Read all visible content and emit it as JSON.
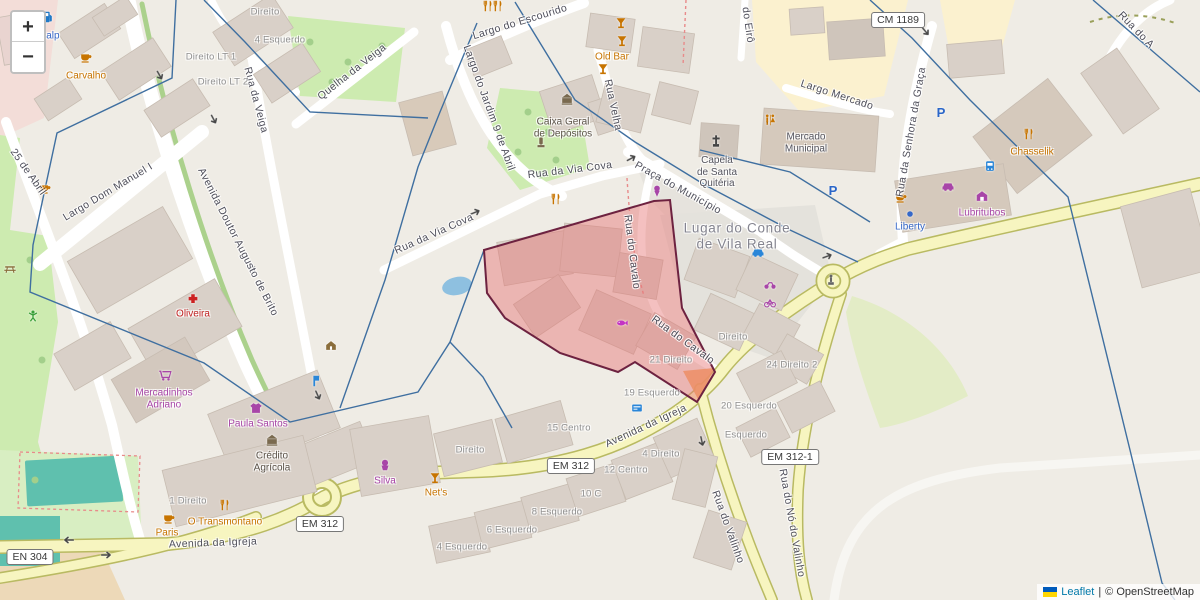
{
  "zoom_control": {
    "zoom_in": "+",
    "zoom_out": "−"
  },
  "attribution": {
    "leaflet": "Leaflet",
    "separator": "|",
    "osm_credit": "© OpenStreetMap"
  },
  "shields": [
    {
      "t": "CM 1189",
      "x": 898,
      "y": 20
    },
    {
      "t": "EM 312",
      "x": 571,
      "y": 466
    },
    {
      "t": "EM 312",
      "x": 320,
      "y": 524
    },
    {
      "t": "EM 312-1",
      "x": 790,
      "y": 457
    },
    {
      "t": "EN 304",
      "x": 30,
      "y": 557
    }
  ],
  "street_labels": [
    {
      "t": "Largo do Escourido",
      "x": 520,
      "y": 22,
      "r": -17
    },
    {
      "t": "Largo do Jardim 9 de Abril",
      "x": 489,
      "y": 108,
      "r": 70
    },
    {
      "t": "Quelha da Veiga",
      "x": 352,
      "y": 72,
      "r": -38
    },
    {
      "t": "Rua da Veiga",
      "x": 256,
      "y": 100,
      "r": 75
    },
    {
      "t": "Largo Dom Manuel I",
      "x": 108,
      "y": 192,
      "r": -31
    },
    {
      "t": "Avenida Doutor Augusto de Brito",
      "x": 238,
      "y": 242,
      "r": 63
    },
    {
      "t": "Rua da Via Cova",
      "x": 570,
      "y": 170,
      "r": -7
    },
    {
      "t": "Rua da Via Cova",
      "x": 434,
      "y": 234,
      "r": -24
    },
    {
      "t": "Rua Velha",
      "x": 613,
      "y": 105,
      "r": 78
    },
    {
      "t": "Praça do Município",
      "x": 678,
      "y": 188,
      "r": 29
    },
    {
      "t": "Largo Mercado",
      "x": 837,
      "y": 95,
      "r": 18
    },
    {
      "t": "Rua da Senhora da Graça",
      "x": 911,
      "y": 132,
      "r": -80
    },
    {
      "t": "do Eirô",
      "x": 748,
      "y": 25,
      "r": 82
    },
    {
      "t": "Rua do A",
      "x": 1136,
      "y": 30,
      "r": 46
    },
    {
      "t": "25 de Abril",
      "x": 28,
      "y": 172,
      "r": 55
    },
    {
      "t": "Rua do Cavalo",
      "x": 632,
      "y": 252,
      "r": 83
    },
    {
      "t": "Rua do Cavalo",
      "x": 683,
      "y": 340,
      "r": 36
    },
    {
      "t": "Avenida da Igreja",
      "x": 646,
      "y": 426,
      "r": -25
    },
    {
      "t": "Avenida da Igreja",
      "x": 213,
      "y": 543,
      "r": -2
    },
    {
      "t": "Rua do Valinho",
      "x": 728,
      "y": 527,
      "r": 70
    },
    {
      "t": "Rua do Nó do Valinho",
      "x": 792,
      "y": 523,
      "r": 80
    }
  ],
  "poi_labels": [
    {
      "t": "Galp",
      "x": 49,
      "y": 36,
      "c": "blue"
    },
    {
      "t": "Carvalho",
      "x": 86,
      "y": 76,
      "c": "orange"
    },
    {
      "t": "Old Bar",
      "x": 612,
      "y": 57,
      "c": "orange"
    },
    {
      "t": "Oliveira",
      "x": 193,
      "y": 314,
      "c": "red"
    },
    {
      "t": "Mercadinhos\nAdriano",
      "x": 164,
      "y": 399,
      "c": "purple"
    },
    {
      "t": "Paula Santos",
      "x": 258,
      "y": 424,
      "c": "purple"
    },
    {
      "t": "Crédito\nAgrícola",
      "x": 272,
      "y": 462,
      "c": "dark"
    },
    {
      "t": "O Transmontano",
      "x": 225,
      "y": 522,
      "c": "orange"
    },
    {
      "t": "Paris",
      "x": 167,
      "y": 533,
      "c": "orange"
    },
    {
      "t": "Silva",
      "x": 385,
      "y": 481,
      "c": "purple"
    },
    {
      "t": "Net's",
      "x": 436,
      "y": 493,
      "c": "orange"
    },
    {
      "t": "Chasselik",
      "x": 1032,
      "y": 152,
      "c": "orange"
    },
    {
      "t": "Lubritubos",
      "x": 982,
      "y": 213,
      "c": "purple"
    },
    {
      "t": "Liberty",
      "x": 910,
      "y": 227,
      "c": "blue"
    },
    {
      "t": "Caixa Geral\nde Depósitos",
      "x": 563,
      "y": 128,
      "c": "dark"
    },
    {
      "t": "Mercado\nMunicipal",
      "x": 806,
      "y": 143,
      "c": "gray"
    },
    {
      "t": "Capela\nde Santa\nQuitéria",
      "x": 717,
      "y": 172,
      "c": "gray"
    },
    {
      "t": "Lugar do Conde\nde Vila Real",
      "x": 737,
      "y": 236,
      "c": "place"
    }
  ],
  "addr_labels": [
    {
      "t": "Direito",
      "x": 265,
      "y": 13
    },
    {
      "t": "4 Esquerdo",
      "x": 280,
      "y": 41
    },
    {
      "t": "Direito\nLT 1",
      "x": 211,
      "y": 58
    },
    {
      "t": "Direito\nLT 2",
      "x": 223,
      "y": 83
    },
    {
      "t": "Direito",
      "x": 470,
      "y": 451
    },
    {
      "t": "15 Centro",
      "x": 569,
      "y": 429
    },
    {
      "t": "21 Direito",
      "x": 671,
      "y": 361
    },
    {
      "t": "19 Esquerdo",
      "x": 652,
      "y": 394
    },
    {
      "t": "20 Esquerdo",
      "x": 749,
      "y": 407
    },
    {
      "t": "24 Direito\n2",
      "x": 792,
      "y": 366
    },
    {
      "t": "Esquerdo",
      "x": 746,
      "y": 436
    },
    {
      "t": "4 Direito",
      "x": 661,
      "y": 455
    },
    {
      "t": "12 Centro",
      "x": 626,
      "y": 471
    },
    {
      "t": "10 C",
      "x": 591,
      "y": 495
    },
    {
      "t": "8 Esquerdo",
      "x": 557,
      "y": 513
    },
    {
      "t": "6 Esquerdo",
      "x": 512,
      "y": 531
    },
    {
      "t": "4 Esquerdo",
      "x": 462,
      "y": 548
    },
    {
      "t": "1 Direito",
      "x": 188,
      "y": 502
    },
    {
      "t": "Direito",
      "x": 733,
      "y": 338
    }
  ],
  "icons": [
    {
      "n": "fuel-station",
      "s": "fuel",
      "x": 47,
      "y": 17,
      "color": "#2079c7"
    },
    {
      "n": "cafe-cup",
      "s": "cup",
      "x": 86,
      "y": 57,
      "color": "#c77400"
    },
    {
      "n": "cafe-cup",
      "s": "cup",
      "x": 169,
      "y": 518,
      "color": "#c77400"
    },
    {
      "n": "cafe-cup",
      "s": "cup",
      "x": 45,
      "y": 188,
      "color": "#c77400"
    },
    {
      "n": "cafe-cup",
      "s": "cup",
      "x": 901,
      "y": 197,
      "color": "#c77400"
    },
    {
      "n": "bar-cocktail",
      "s": "cocktail",
      "x": 621,
      "y": 23,
      "color": "#c77400"
    },
    {
      "n": "bar-cocktail",
      "s": "cocktail",
      "x": 622,
      "y": 41,
      "color": "#c77400"
    },
    {
      "n": "bar-cocktail",
      "s": "cocktail",
      "x": 603,
      "y": 69,
      "color": "#c77400"
    },
    {
      "n": "bar-cocktail",
      "s": "cocktail",
      "x": 435,
      "y": 478,
      "color": "#c77400"
    },
    {
      "n": "restaurant",
      "s": "forkknife",
      "x": 488,
      "y": 6,
      "color": "#c77400"
    },
    {
      "n": "restaurant",
      "s": "forkknife",
      "x": 498,
      "y": 6,
      "color": "#c77400"
    },
    {
      "n": "restaurant",
      "s": "forkknife",
      "x": 556,
      "y": 199,
      "color": "#c77400"
    },
    {
      "n": "restaurant",
      "s": "forkknife",
      "x": 225,
      "y": 505,
      "color": "#c77400"
    },
    {
      "n": "restaurant",
      "s": "forkknife",
      "x": 1029,
      "y": 134,
      "color": "#c77400"
    },
    {
      "n": "toilets",
      "s": "toilets",
      "x": 770,
      "y": 120,
      "color": "#c77400"
    },
    {
      "n": "pharmacy",
      "s": "pharmacy",
      "x": 193,
      "y": 299,
      "color": "#cc2222"
    },
    {
      "n": "supermarket-cart",
      "s": "cart",
      "x": 165,
      "y": 375,
      "color": "#a845a8"
    },
    {
      "n": "clothes-shop",
      "s": "shirt",
      "x": 256,
      "y": 408,
      "color": "#a845a8"
    },
    {
      "n": "confectionery",
      "s": "cake",
      "x": 385,
      "y": 465,
      "color": "#a845a8"
    },
    {
      "n": "car-repair",
      "s": "car",
      "x": 948,
      "y": 186,
      "color": "#a845a8"
    },
    {
      "n": "garage",
      "s": "garage",
      "x": 982,
      "y": 196,
      "color": "#a845a8"
    },
    {
      "n": "ice-cream",
      "s": "icecream",
      "x": 657,
      "y": 191,
      "color": "#a845a8"
    },
    {
      "n": "motorcycle-parking",
      "s": "motorcycle",
      "x": 770,
      "y": 284,
      "color": "#a845a8"
    },
    {
      "n": "bicycle-parking",
      "s": "bicycle",
      "x": 770,
      "y": 302,
      "color": "#a845a8"
    },
    {
      "n": "fishmonger",
      "s": "fish",
      "x": 622,
      "y": 323,
      "color": "#c433c4"
    },
    {
      "n": "bank",
      "s": "bank",
      "x": 272,
      "y": 440,
      "color": "#7a6a4f"
    },
    {
      "n": "bank",
      "s": "bank",
      "x": 567,
      "y": 99,
      "color": "#7a6a4f"
    },
    {
      "n": "memorial",
      "s": "memorial",
      "x": 541,
      "y": 142,
      "color": "#7a6a4f"
    },
    {
      "n": "kiosk-hut",
      "s": "hut",
      "x": 331,
      "y": 345,
      "color": "#8a6d3b"
    },
    {
      "n": "picnic-table",
      "s": "picnic",
      "x": 10,
      "y": 268,
      "color": "#8a6d3b"
    },
    {
      "n": "playground",
      "s": "playground",
      "x": 33,
      "y": 316,
      "color": "#3aa03a"
    },
    {
      "n": "church-cross",
      "s": "cross",
      "x": 716,
      "y": 141,
      "color": "#444444"
    },
    {
      "n": "statue",
      "s": "statue",
      "x": 831,
      "y": 280,
      "color": "#666666"
    },
    {
      "n": "parking",
      "s": "parking",
      "x": 941,
      "y": 112,
      "color": "#2a66c8"
    },
    {
      "n": "parking",
      "s": "parking",
      "x": 833,
      "y": 190,
      "color": "#2a66c8"
    },
    {
      "n": "taxi",
      "s": "car",
      "x": 758,
      "y": 252,
      "color": "#2a86d8"
    },
    {
      "n": "office-dot",
      "s": "dot",
      "x": 910,
      "y": 214,
      "color": "#3568c9"
    },
    {
      "n": "bus-station",
      "s": "bus",
      "x": 990,
      "y": 166,
      "color": "#2a86d8"
    },
    {
      "n": "bus-stop",
      "s": "busstop",
      "x": 316,
      "y": 381,
      "color": "#2a86d8"
    },
    {
      "n": "atm",
      "s": "atm",
      "x": 637,
      "y": 408,
      "color": "#2a86d8"
    },
    {
      "n": "oneway-arrow",
      "s": "arrow",
      "x": 160,
      "y": 76,
      "color": "#484848",
      "r": 60
    },
    {
      "n": "oneway-arrow",
      "s": "arrow",
      "x": 214,
      "y": 120,
      "color": "#484848",
      "r": 62
    },
    {
      "n": "oneway-arrow",
      "s": "arrow",
      "x": 252,
      "y": 268,
      "color": "#484848",
      "r": 64
    },
    {
      "n": "oneway-arrow",
      "s": "arrow",
      "x": 318,
      "y": 396,
      "color": "#484848",
      "r": 66
    },
    {
      "n": "oneway-arrow",
      "s": "arrow",
      "x": 476,
      "y": 212,
      "color": "#484848",
      "r": -22
    },
    {
      "n": "oneway-arrow",
      "s": "arrow",
      "x": 632,
      "y": 158,
      "color": "#484848",
      "r": -28
    },
    {
      "n": "oneway-arrow",
      "s": "arrow",
      "x": 702,
      "y": 442,
      "color": "#484848",
      "r": 78
    },
    {
      "n": "oneway-arrow",
      "s": "arrow",
      "x": 828,
      "y": 256,
      "color": "#484848",
      "r": -20
    },
    {
      "n": "oneway-arrow",
      "s": "arrow",
      "x": 926,
      "y": 32,
      "color": "#484848",
      "r": 50
    },
    {
      "n": "oneway-arrow",
      "s": "arrow",
      "x": 68,
      "y": 540,
      "color": "#484848",
      "r": 180
    },
    {
      "n": "oneway-arrow",
      "s": "arrow",
      "x": 107,
      "y": 555,
      "color": "#484848",
      "r": 0
    }
  ],
  "overlays": {
    "selection_polygon": {
      "points": [
        [
          484,
          250
        ],
        [
          564,
          227
        ],
        [
          654,
          201
        ],
        [
          670,
          200
        ],
        [
          682,
          308
        ],
        [
          715,
          372
        ],
        [
          697,
          402
        ],
        [
          635,
          362
        ],
        [
          618,
          372
        ],
        [
          560,
          353
        ],
        [
          505,
          318
        ],
        [
          487,
          293
        ]
      ],
      "fill": "rgba(231,115,115,0.45)",
      "stroke": "#6d2240",
      "stroke_width": 2
    },
    "orange_patch": {
      "points": [
        [
          683,
          371
        ],
        [
          714,
          368
        ],
        [
          699,
          401
        ]
      ],
      "fill": "rgba(242,166,90,0.85)"
    },
    "boundaries": {
      "color": "#3f6fa0",
      "width": 1.4,
      "chains": [
        [
          [
            176,
            0
          ],
          [
            172,
            78
          ],
          [
            57,
            133
          ],
          [
            33,
            245
          ],
          [
            30,
            292
          ],
          [
            204,
            363
          ],
          [
            290,
            422
          ],
          [
            418,
            392
          ],
          [
            450,
            342
          ],
          [
            484,
            250
          ]
        ],
        [
          [
            450,
            342
          ],
          [
            483,
            377
          ],
          [
            512,
            428
          ]
        ],
        [
          [
            204,
            0
          ],
          [
            245,
            42
          ],
          [
            310,
            112
          ],
          [
            428,
            118
          ]
        ],
        [
          [
            477,
            23
          ],
          [
            440,
            112
          ],
          [
            418,
            167
          ],
          [
            385,
            280
          ],
          [
            340,
            408
          ]
        ],
        [
          [
            515,
            2
          ],
          [
            575,
            100
          ],
          [
            635,
            142
          ],
          [
            705,
            185
          ],
          [
            790,
            230
          ],
          [
            858,
            262
          ]
        ],
        [
          [
            700,
            150
          ],
          [
            790,
            172
          ],
          [
            870,
            222
          ]
        ],
        [
          [
            870,
            0
          ],
          [
            912,
            38
          ],
          [
            970,
            100
          ],
          [
            1068,
            197
          ],
          [
            1130,
            450
          ],
          [
            1162,
            583
          ],
          [
            1175,
            600
          ]
        ],
        [
          [
            1093,
            0
          ],
          [
            1200,
            92
          ]
        ]
      ]
    }
  }
}
